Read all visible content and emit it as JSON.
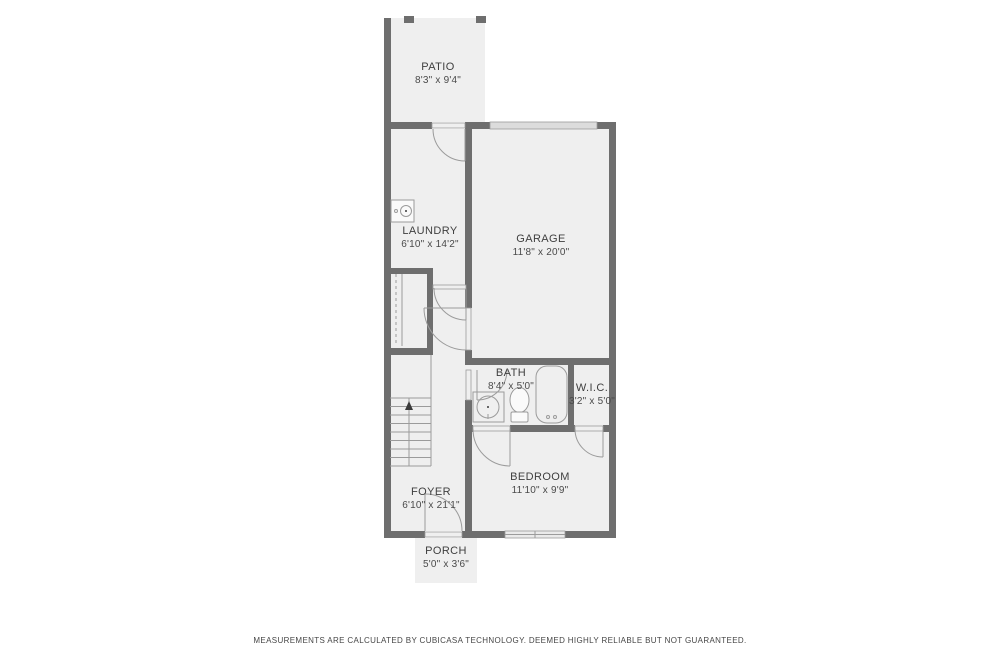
{
  "plan": {
    "rooms": {
      "patio": {
        "name": "PATIO",
        "dims": "8'3\" x 9'4\""
      },
      "laundry": {
        "name": "LAUNDRY",
        "dims": "6'10\" x 14'2\""
      },
      "garage": {
        "name": "GARAGE",
        "dims": "11'8\" x 20'0\""
      },
      "bath": {
        "name": "BATH",
        "dims": "8'4\" x 5'0\""
      },
      "wic": {
        "name": "W.I.C.",
        "dims": "3'2\" x 5'0\""
      },
      "bedroom": {
        "name": "BEDROOM",
        "dims": "11'10\" x 9'9\""
      },
      "foyer": {
        "name": "FOYER",
        "dims": "6'10\" x 21'1\""
      },
      "porch": {
        "name": "PORCH",
        "dims": "5'0\" x 3'6\""
      }
    },
    "disclaimer": "MEASUREMENTS ARE CALCULATED BY CUBICASA TECHNOLOGY. DEEMED HIGHLY RELIABLE BUT NOT GUARANTEED.",
    "colors": {
      "wall": "#6e6e6e",
      "floor": "#efefef",
      "line": "#9b9b9b",
      "text": "#3f3f3f"
    }
  }
}
